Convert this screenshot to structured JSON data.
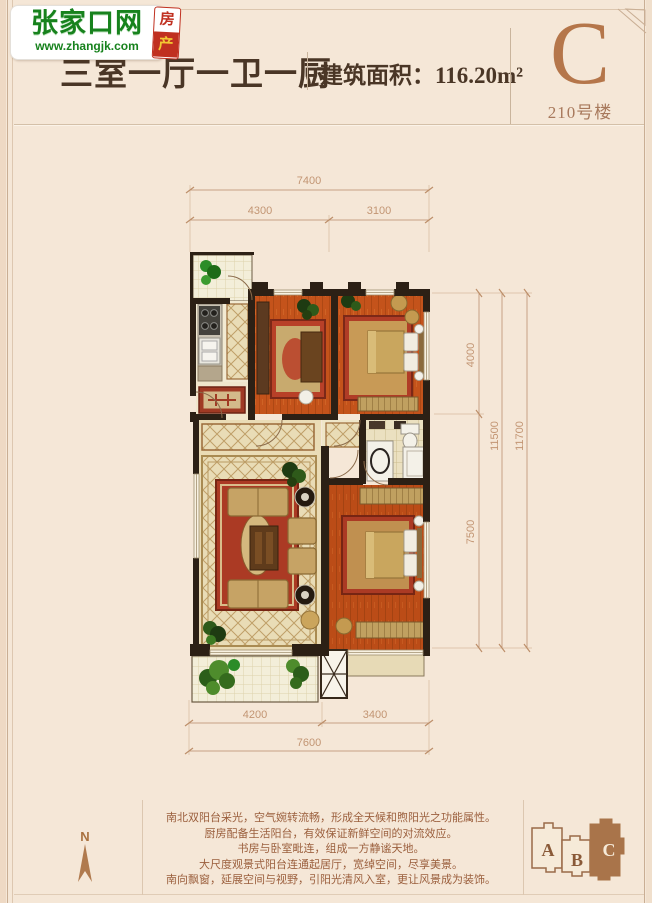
{
  "logo": {
    "site_name": "张家口网",
    "site_url": "www.zhangjk.com",
    "badge_top": "房",
    "badge_bottom": "产"
  },
  "header": {
    "title": "三室一厅一卫一厨",
    "area_label": "建筑面积：116.20m²",
    "unit_letter": "C",
    "building_label": "210号楼"
  },
  "floorplan": {
    "dims": {
      "top_total": "7400",
      "top_left": "4300",
      "top_right": "3100",
      "right_upper": "4000",
      "right_lower": "7500",
      "right_inner_total": "11500",
      "right_outer_total": "11700",
      "bottom_left": "4200",
      "bottom_right": "3400",
      "bottom_total": "7600"
    }
  },
  "footer": {
    "compass_label": "N",
    "description_lines": [
      "南北双阳台采光，空气婉转流畅，形成全天候和煦阳光之功能属性。",
      "厨房配备生活阳台，有效保证新鲜空间的对流效应。",
      "书房与卧室毗连，组成一方静谧天地。",
      "大尺度观景式阳台连通起居厅，宽绰空间，尽享美景。",
      "南向飘窗，延展空间与视野，引阳光清风入室，更让风景成为装饰。"
    ],
    "legend": {
      "building_a": "A",
      "building_b": "B",
      "building_c": "C"
    }
  },
  "colors": {
    "accent_copper": "#b5764a",
    "wall": "#2c2015",
    "wood_floor": "#c4531b",
    "dimension": "#c29573",
    "logo_green": "#17821d",
    "badge_red": "#c03020",
    "text_brown": "#9b5f3d",
    "title_brown": "#4a3626"
  }
}
